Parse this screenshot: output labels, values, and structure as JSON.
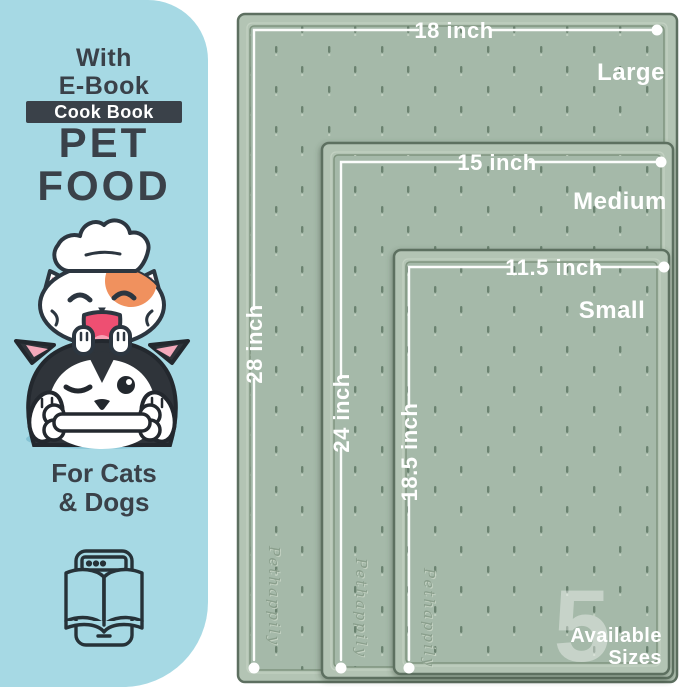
{
  "left_panel": {
    "bg_color": "#a6d9e4",
    "text_color": "#3a4149",
    "ebook_line1": "With",
    "ebook_line2": "E-Book",
    "badge": {
      "label": "Cook Book",
      "bg_color": "#3a4149",
      "text_color": "#ffffff"
    },
    "title_line1": "PET",
    "title_line2": "FOOD",
    "audience_line1": "For Cats",
    "audience_line2": "& Dogs",
    "illustration": "chef-cat-on-winking-dog-with-bone",
    "icon": "ebook-tablet-with-open-book"
  },
  "mat_diagram": {
    "mat_color": "#a5b9a9",
    "rim_color": "#b3c4b4",
    "edge_color": "#5d6f60",
    "texture_dot_color": "#6b8270",
    "line_color": "#ffffff",
    "embossed_brand": "Pethappily",
    "sizes": [
      {
        "name": "Large",
        "width": "18 inch",
        "height": "28 inch"
      },
      {
        "name": "Medium",
        "width": "15 inch",
        "height": "24 inch"
      },
      {
        "name": "Small",
        "width": "11.5 inch",
        "height": "18.5 inch"
      }
    ],
    "badge_number": "5",
    "badge_line1": "Available",
    "badge_line2": "Sizes"
  }
}
